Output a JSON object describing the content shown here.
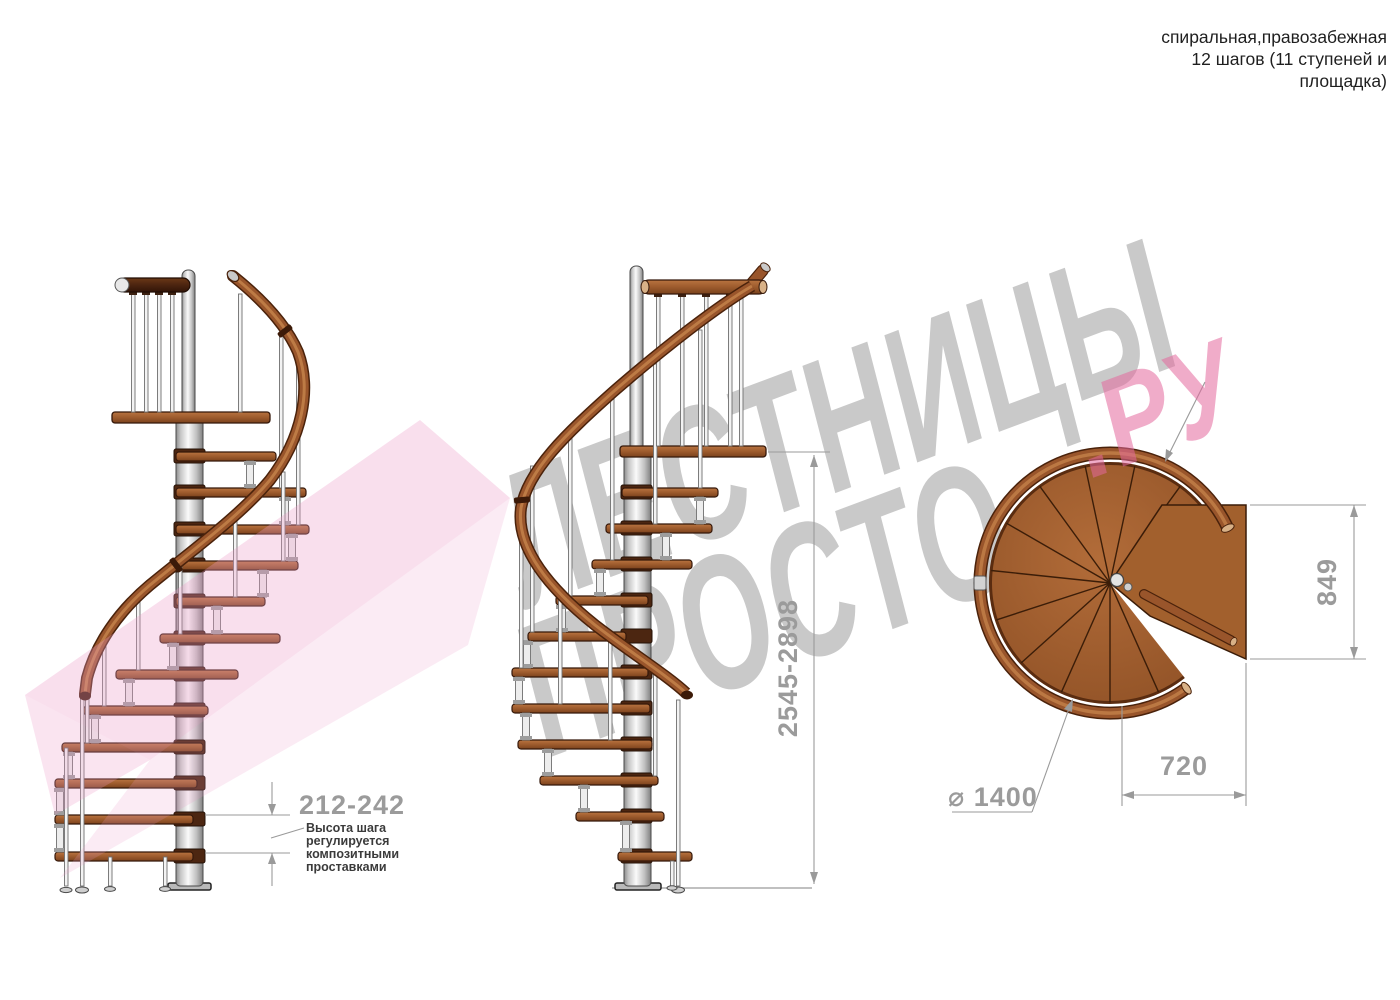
{
  "title": {
    "line1": "спиральная,правозабежная",
    "line2": "12 шагов (11 ступеней и",
    "line3": "площадка)"
  },
  "watermark": {
    "word1": "ЛЕСТНИЦЫ",
    "word2": "ПРОСТО",
    "suffix": ".РУ"
  },
  "dimensions": {
    "step_height": "212-242",
    "total_height": "2545-2898",
    "landing_depth": "849",
    "landing_width": "720",
    "diameter": "⌀ 1400"
  },
  "note": {
    "lines": [
      "Высота шага",
      "регулируется",
      "композитными",
      "проставками"
    ]
  },
  "colors": {
    "wood_mid": "#9d5b2d",
    "wood_dark_rail": "#53270e",
    "metal_light": "#f3f3f3",
    "dimension_gray": "#9b9b9b",
    "watermark_gray": "#c9c9c9",
    "watermark_pink": "#f2b4cb",
    "logo_pink": "#f3cfe2"
  }
}
